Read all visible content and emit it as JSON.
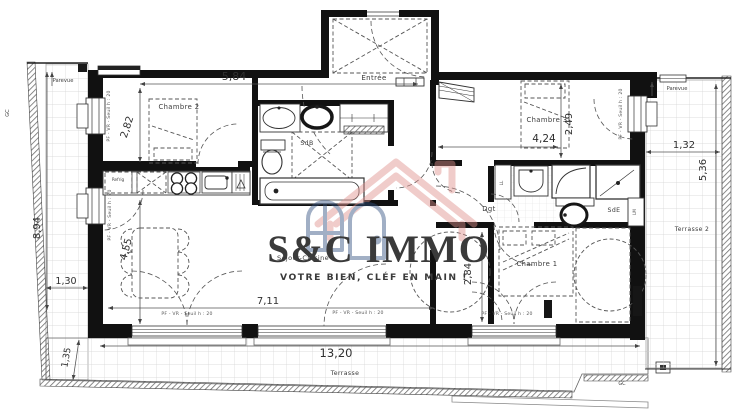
{
  "plan": {
    "logo": {
      "name": "S&C IMMO",
      "tagline": "VOTRE BIEN, CLÉF EN MAIN !"
    },
    "rooms": {
      "entree": "Entrée",
      "chambre1": "Chambre 1",
      "chambre2": "Chambre 2",
      "chambre3": "Chambre 3",
      "sdb": "SdB",
      "sde": "SdE",
      "dgt": "Dgt",
      "sejour": "Séjour-Cuisine",
      "terrasse": "Terrasse",
      "terrasse2": "Terrasse 2"
    },
    "annotations": {
      "parevue": "Parevue",
      "gc": "GC",
      "refrig": "Refrig",
      "ll": "LL",
      "lm": "LM",
      "window_label": "PF - VR - Seuil h : 20"
    },
    "dimensions": {
      "top_width": "5,84",
      "ch2_height": "2,82",
      "ch3_width": "4,24",
      "ch3_height": "2,49",
      "t2_width": "1,32",
      "t2_height": "5,36",
      "t1_height": "8,94",
      "t1_width": "1,30",
      "sejour_height": "4,55",
      "sejour_width": "7,11",
      "ch1_height": "2,84",
      "terrasse_width": "13,20",
      "terrasse_depth": "1,35"
    },
    "colors": {
      "wall": "#111111",
      "logo_navy": "#1d3763",
      "logo_red": "#d8423c",
      "house_pink": "#e08f8b",
      "house_blue": "#31507f"
    }
  }
}
